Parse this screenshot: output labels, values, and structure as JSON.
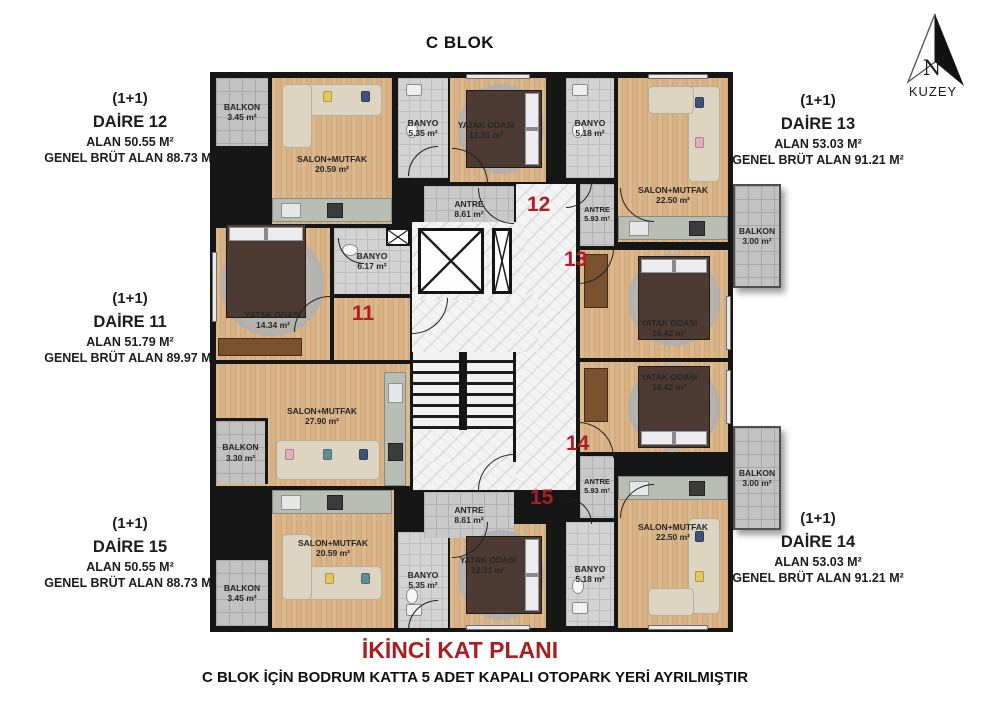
{
  "header": {
    "title": "C BLOK"
  },
  "north_arrow": {
    "letter": "N",
    "label": "KUZEY"
  },
  "footer": {
    "title": "İKİNCİ KAT PLANI",
    "note": "C BLOK İÇİN BODRUM KATTA 5 ADET KAPALI OTOPARK YERİ AYRILMIŞTIR"
  },
  "panels": {
    "daire12": {
      "type": "(1+1)",
      "name": "DAİRE 12",
      "alan": "ALAN 50.55 M²",
      "brut": "GENEL BRÜT ALAN 88.73 M²"
    },
    "daire13": {
      "type": "(1+1)",
      "name": "DAİRE 13",
      "alan": "ALAN 53.03 M²",
      "brut": "GENEL BRÜT ALAN 91.21 M²"
    },
    "daire11": {
      "type": "(1+1)",
      "name": "DAİRE 11",
      "alan": "ALAN 51.79 M²",
      "brut": "GENEL BRÜT ALAN 89.97 M²"
    },
    "daire15": {
      "type": "(1+1)",
      "name": "DAİRE 15",
      "alan": "ALAN 50.55 M²",
      "brut": "GENEL BRÜT ALAN 88.73 M²"
    },
    "daire14": {
      "type": "(1+1)",
      "name": "DAİRE 14",
      "alan": "ALAN 53.03 M²",
      "brut": "GENEL BRÜT ALAN 91.21 M²"
    }
  },
  "units": {
    "u11": "11",
    "u12": "12",
    "u13": "13",
    "u14": "14",
    "u15": "15"
  },
  "rooms": {
    "d12_balkon": {
      "name": "BALKON",
      "area": "3.45 m²"
    },
    "d12_salon": {
      "name": "SALON+MUTFAK",
      "area": "20.59 m²"
    },
    "d12_banyo": {
      "name": "BANYO",
      "area": "5.35 m²"
    },
    "d12_yatak": {
      "name": "YATAK ODASI",
      "area": "12.31 m²"
    },
    "d12_antre": {
      "name": "ANTRE",
      "area": "8.61 m²"
    },
    "d13_banyo": {
      "name": "BANYO",
      "area": "5.18 m²"
    },
    "d13_antre": {
      "name": "ANTRE",
      "area": "5.93 m²"
    },
    "d13_salon": {
      "name": "SALON+MUTFAK",
      "area": "22.50 m²"
    },
    "d13_yatak": {
      "name": "YATAK ODASI",
      "area": "16.42 m²"
    },
    "d13_balkon": {
      "name": "BALKON",
      "area": "3.00 m²"
    },
    "d11_yatak": {
      "name": "YATAK ODASI",
      "area": "14.34 m²"
    },
    "d11_banyo": {
      "name": "BANYO",
      "area": "6.17 m²"
    },
    "d11_salon": {
      "name": "SALON+MUTFAK",
      "area": "27.90 m²"
    },
    "d11_balkon": {
      "name": "BALKON",
      "area": "3.30 m²"
    },
    "d14_yatak": {
      "name": "YATAK ODASI",
      "area": "16.42 m²"
    },
    "d14_antre": {
      "name": "ANTRE",
      "area": "5.93 m²"
    },
    "d14_banyo": {
      "name": "BANYO",
      "area": "5.18 m²"
    },
    "d14_salon": {
      "name": "SALON+MUTFAK",
      "area": "22.50 m²"
    },
    "d14_balkon": {
      "name": "BALKON",
      "area": "3.00 m²"
    },
    "d15_salon": {
      "name": "SALON+MUTFAK",
      "area": "20.59 m²"
    },
    "d15_balkon": {
      "name": "BALKON",
      "area": "3.45 m²"
    },
    "d15_banyo": {
      "name": "BANYO",
      "area": "5.35 m²"
    },
    "d15_yatak": {
      "name": "YATAK ODASI",
      "area": "12.31 m²"
    },
    "d15_antre": {
      "name": "ANTRE",
      "area": "8.61 m²"
    }
  },
  "colors": {
    "accent_red": "#ad1f23",
    "wall": "#161616",
    "wood": "#d7b388",
    "tile": "#d3d3d3",
    "marble": "#f4f4f4"
  }
}
